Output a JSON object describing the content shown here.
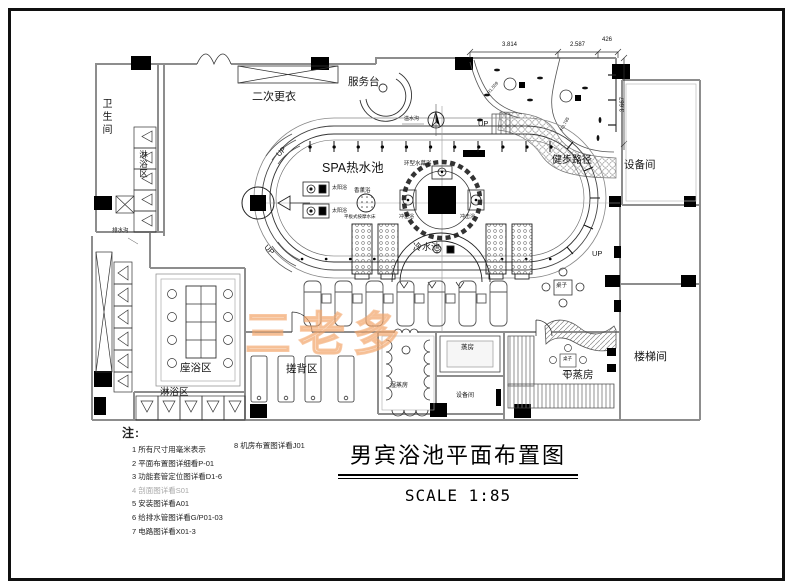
{
  "title_block": {
    "title": "男宾浴池平面布置图",
    "scale": "SCALE 1:85"
  },
  "watermark": {
    "text": "三老多"
  },
  "notes": {
    "heading": "注:",
    "items": [
      "1 所有尺寸用毫米表示",
      "2 平面布置图详细看P-01",
      "3 功能套管定位图详看D1-6",
      "4 剖面图详看S01",
      "5 安装图详看A01",
      "6 给排水管图详看G/P01-03",
      "7 电路图详看X01-3"
    ],
    "side_item": "8 机房布置图详看J01"
  },
  "dimensions": {
    "top_left": "3.814",
    "top_mid": "2.587",
    "top_right": "426",
    "right_side": "3.667",
    "radius_a": "R1.559",
    "radius_b": "R3.785"
  },
  "labels": {
    "toilet": "卫生间",
    "shower": "淋浴区",
    "changing": "二次更衣",
    "service_desk": "服务台",
    "walk_path": "健步路径",
    "equipment": "设备间",
    "spa_pool": "SPA热水池",
    "ring_curtain": "环型水幕浴",
    "aroma": "香薰浴",
    "sun": "太阳浴",
    "impact": "冲击浴",
    "massage_bed": "平板式按摩水床",
    "cold_pool": "冷水池",
    "overflow": "溢水沟",
    "drain": "排水沟",
    "sit_bath": "座浴区",
    "scrub": "搓背区",
    "wet_steam": "湿蒸房",
    "steam": "蒸房",
    "dry_steam": "干蒸房",
    "stair": "楼梯间",
    "table": "桌子",
    "up": "UP"
  }
}
